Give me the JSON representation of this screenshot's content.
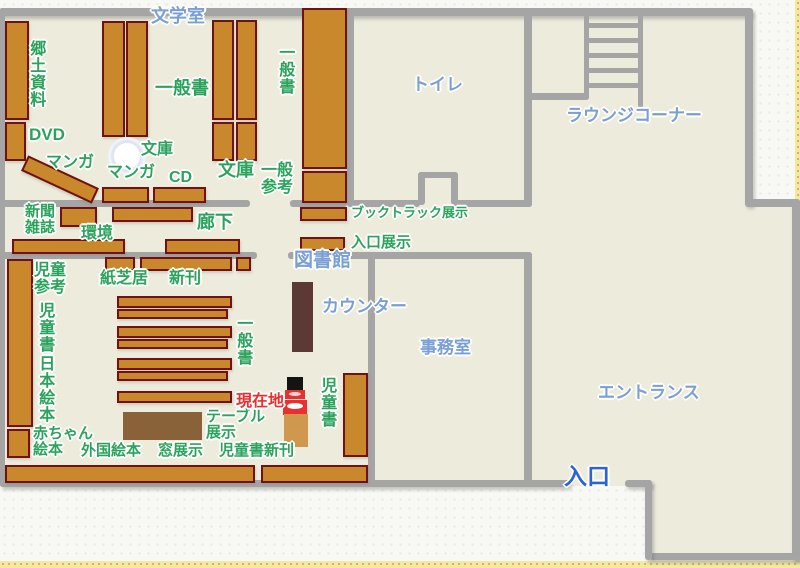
{
  "map_title": "library-floor-map",
  "rooms": {
    "literature_room": "文学室",
    "toilet": "トイレ",
    "lounge_corner": "ラウンジコーナー",
    "library": "図書館",
    "counter": "カウンター",
    "office": "事務室",
    "entrance_hall": "エントランス",
    "entrance": "入口"
  },
  "sections": {
    "local_materials": "郷土資料",
    "dvd": "DVD",
    "manga_a": "マンガ",
    "manga_b": "マンガ",
    "cd": "CD",
    "bunko_a": "文庫",
    "bunko_b": "文庫",
    "general_books_a": "一般書",
    "general_books_b": "一般書",
    "general_books_c": "一般書",
    "general_reference": "一般\n参考",
    "booktruck_display": "ブックトラック展示",
    "entrance_display": "入口展示",
    "newspaper_magazines": "新聞\n雑誌",
    "environment": "環境",
    "corridor": "廊下",
    "kamishibai": "紙芝居",
    "new_books": "新刊",
    "children_reference": "児童\n参考",
    "children_books_a": "児童書",
    "children_books_b": "児童書",
    "japanese_picture_books": "日本絵本",
    "baby_picture_books": "赤ちゃん\n絵本",
    "foreign_picture_books": "外国絵本",
    "window_display": "窓展示",
    "children_new_books": "児童書新刊",
    "table_display": "テーブル\n展示",
    "current_location": "現在地"
  },
  "colors": {
    "floor": "#ecebdc",
    "paper": "#f8f8f4",
    "wall": "#a5a5a5",
    "shelf_fill": "#c9882b",
    "shelf_border": "#701212",
    "counter": "#5d3936",
    "table": "#8a6239",
    "kiosk": "#d0984f",
    "label_green": "#2ba35c",
    "label_blue": "#7a9fd4",
    "label_blue_strong": "#2c64d8",
    "label_red": "#e92f2f",
    "edge_band": "#f2eb9e"
  }
}
